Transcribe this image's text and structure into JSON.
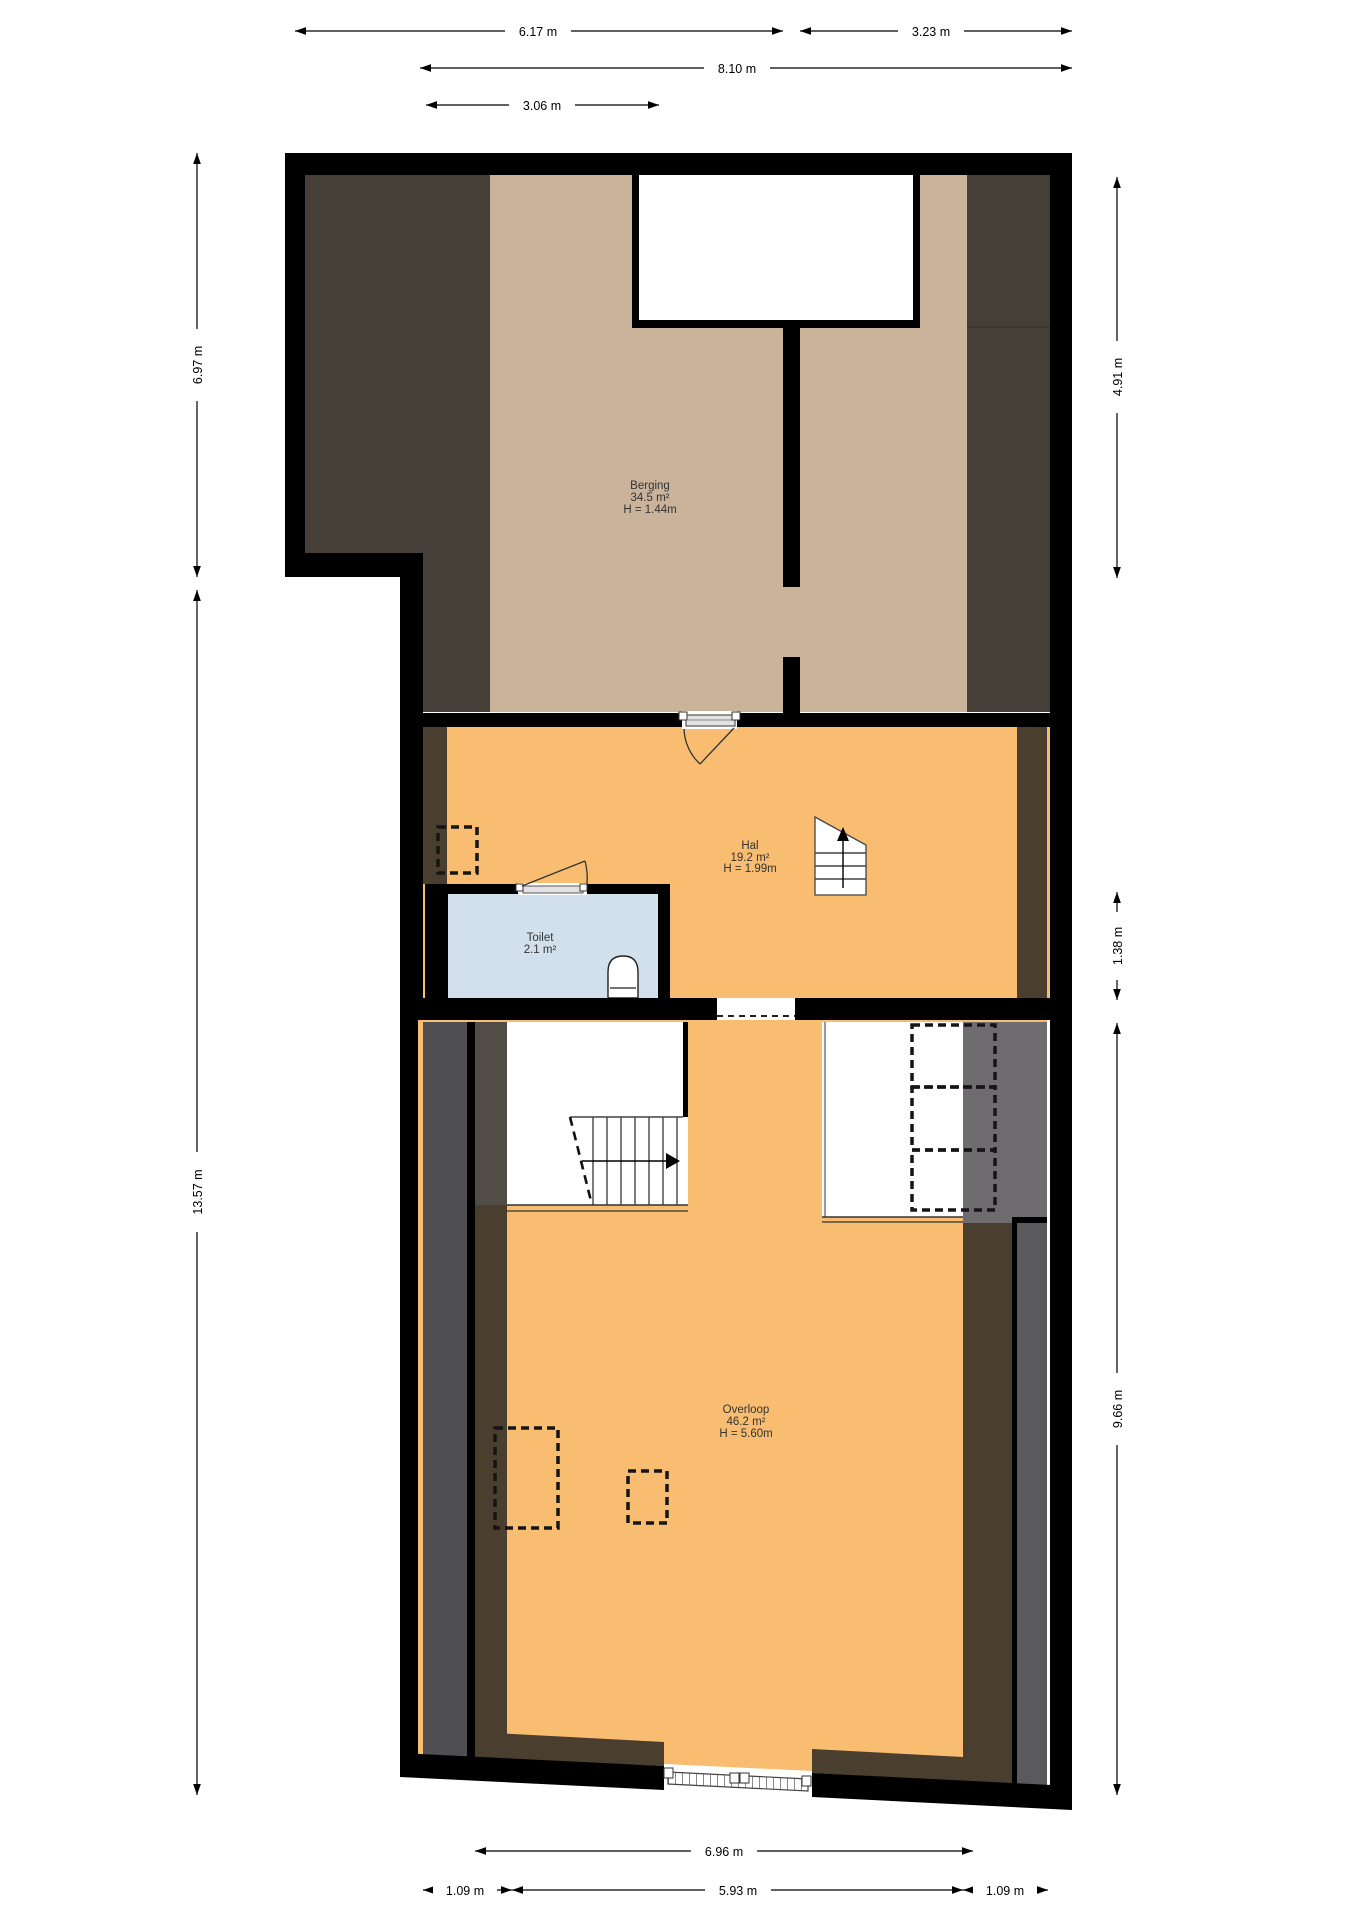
{
  "plan": {
    "type": "floor-plan",
    "floor_name": "attic / second floor",
    "rooms": {
      "berging": {
        "name": "Berging",
        "area": "34.5 m²",
        "height": "H = 1.44m"
      },
      "hal": {
        "name": "Hal",
        "area": "19.2 m²",
        "height": "H = 1.99m"
      },
      "toilet": {
        "name": "Toilet",
        "area": "2.1 m²"
      },
      "overloop": {
        "name": "Overloop",
        "area": "46.2 m²",
        "height": "H = 5.60m"
      }
    },
    "dims": {
      "top_left_width": "6.17 m",
      "top_right_width": "3.23 m",
      "total_width": "8.10 m",
      "stair_width": "3.06 m",
      "left_upper": "6.97 m",
      "left_lower": "13.57 m",
      "right_upper": "4.91 m",
      "right_middle": "1.38 m",
      "right_lower": "9.66 m",
      "bottom_width": "6.96 m",
      "bottom_left": "1.09 m",
      "bottom_middle": "5.93 m",
      "bottom_right": "1.09 m"
    },
    "colors": {
      "wall": "#000000",
      "berging_floor": "#cab39a",
      "low_roof": "#453f37",
      "floor_orange": "#f8bd70",
      "toilet_floor": "#d2e0ee",
      "strip_grey": "#4f4f51",
      "strip_greybrown": "#524c46",
      "strip_brown": "#4a3e2e",
      "closet_grey": "#6f6c6f",
      "right_grey": "#5a5a5c",
      "door_slab": "#e3e3e3"
    }
  }
}
